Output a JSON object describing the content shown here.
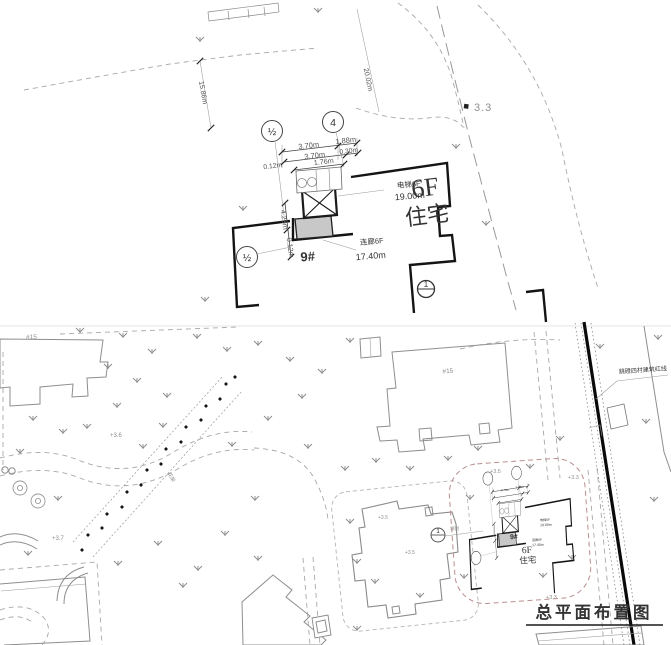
{
  "detail": {
    "axis_a": "½",
    "axis_b": "4",
    "axis_c": "½",
    "ref_circle": "1",
    "dims": {
      "r1l": "3.70m",
      "r1r": "1.88m",
      "r2l": "3.70m",
      "r2r": "0.30m",
      "r3l": "0.12m",
      "r3r": "1.76m",
      "vert_a": "4.25m",
      "vert_b": "0.12m",
      "west": "15.86m",
      "north": "20.02m"
    },
    "spot": "3.3",
    "bldg_no": "9#",
    "floors": "6F",
    "use_type": "住宅",
    "elevator_label": "电梯6F",
    "elevator_value": "19.00m",
    "corridor_label": "连廊6F",
    "corridor_value": "17.40m"
  },
  "site": {
    "bldg_a": "#15",
    "bldg_b": "#15",
    "red_line_label": "跳磴四村建筑红线",
    "ref_circle": "1",
    "ref_label": "详图",
    "pergola": "花架",
    "title": "总平面布置图",
    "elev": {
      "a": "+3.6",
      "b": "+3.7",
      "c": "+3.5",
      "d": "+3.3",
      "e": "+3.3",
      "f": "+3.5",
      "g": "+3.5"
    }
  }
}
